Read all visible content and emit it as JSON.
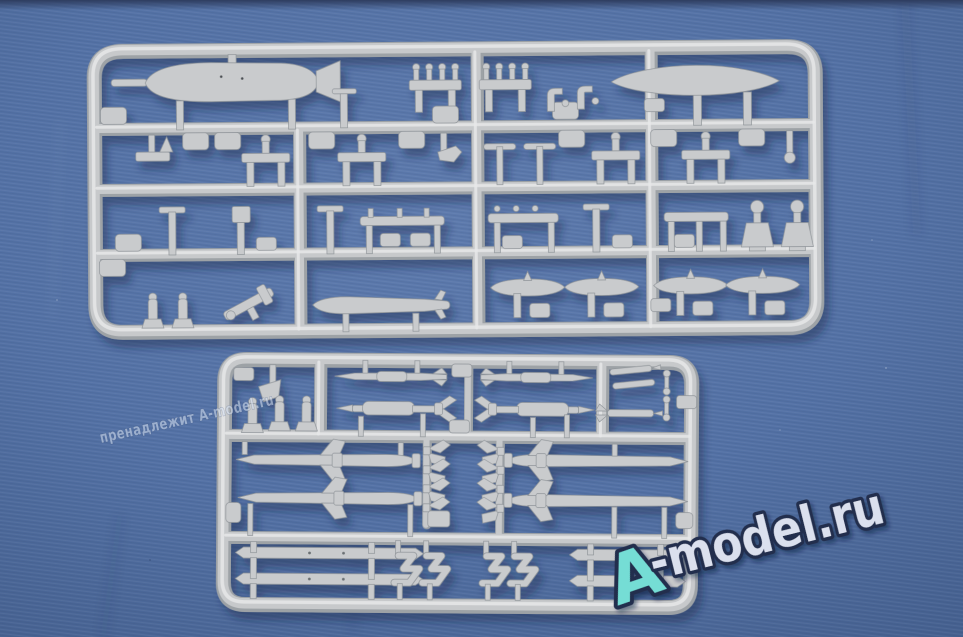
{
  "photo": {
    "alt": "Two light-gray injection-molded model kit sprues with bombs, fuel tanks, missiles and pylon parts photographed on blue fabric"
  },
  "watermarks": {
    "diagonal_text": "пренадлежит A-model.ru",
    "logo": {
      "letter": "A",
      "rest": "-model.ru"
    }
  },
  "colors": {
    "fabric": "#5371a5",
    "fabric_light": "#5d7aad",
    "fabric_edge": "#45608f",
    "sprue": "#c7c9cb",
    "sprue_shadow": "#9da2a6",
    "sprue_highlight": "#e6e8e9",
    "part": "#c9cbcd",
    "part_edge": "#8f9499",
    "logo_a": "#74ddd5",
    "logo_text": "#dbe0ee",
    "logo_outline": "#242f4d",
    "watermark": "#d9e3f2"
  }
}
